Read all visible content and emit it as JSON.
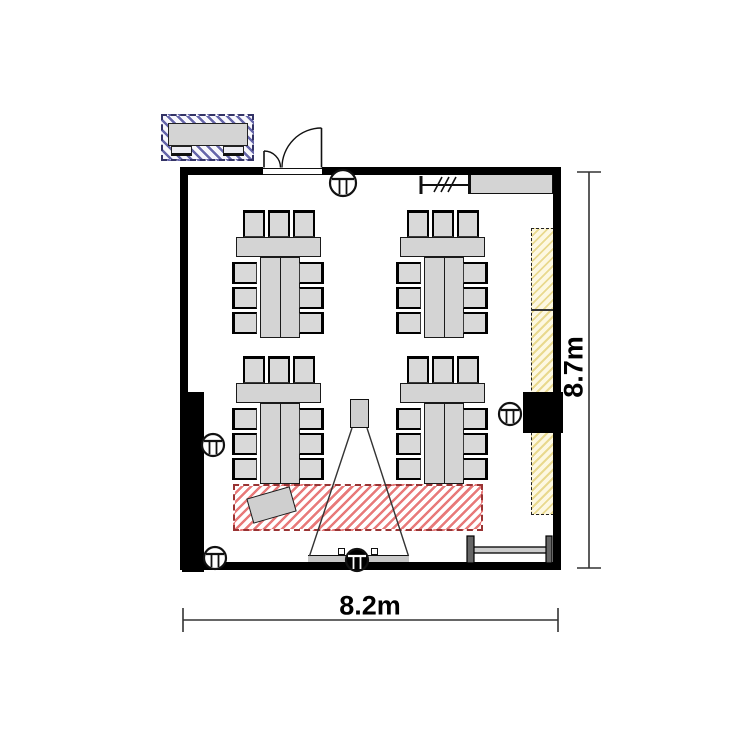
{
  "plan": {
    "width_label": "8.2m",
    "height_label": "8.7m"
  },
  "colors": {
    "wall": "#000000",
    "furniture_fill": "#d4d4d4",
    "outline": "#1a1a1a",
    "red_zone_border": "#993333",
    "red_zone_hatch": "#e87a7a",
    "blue_zone_border": "#333366",
    "blue_zone_hatch": "#6666aa",
    "yellow_zone_hatch": "#e9d98e"
  },
  "furniture": {
    "table_groups": [
      {
        "id": "table-group-top-left",
        "x": 232,
        "y": 209
      },
      {
        "id": "table-group-top-right",
        "x": 396,
        "y": 209
      },
      {
        "id": "table-group-bottom-left",
        "x": 232,
        "y": 355
      },
      {
        "id": "table-group-bottom-right",
        "x": 396,
        "y": 355
      }
    ],
    "group_layout": {
      "top_chairs": 3,
      "left_chairs": 3,
      "right_chairs": 3
    }
  },
  "fixtures": {
    "columns": [
      {
        "cx": 343,
        "cy": 183,
        "r": 13,
        "filled": false
      },
      {
        "cx": 213,
        "cy": 445,
        "r": 11,
        "filled": false
      },
      {
        "cx": 215,
        "cy": 558,
        "r": 11,
        "filled": false
      },
      {
        "cx": 357,
        "cy": 560,
        "r": 11,
        "filled": true
      },
      {
        "cx": 510,
        "cy": 414,
        "r": 11,
        "filled": false
      }
    ]
  }
}
